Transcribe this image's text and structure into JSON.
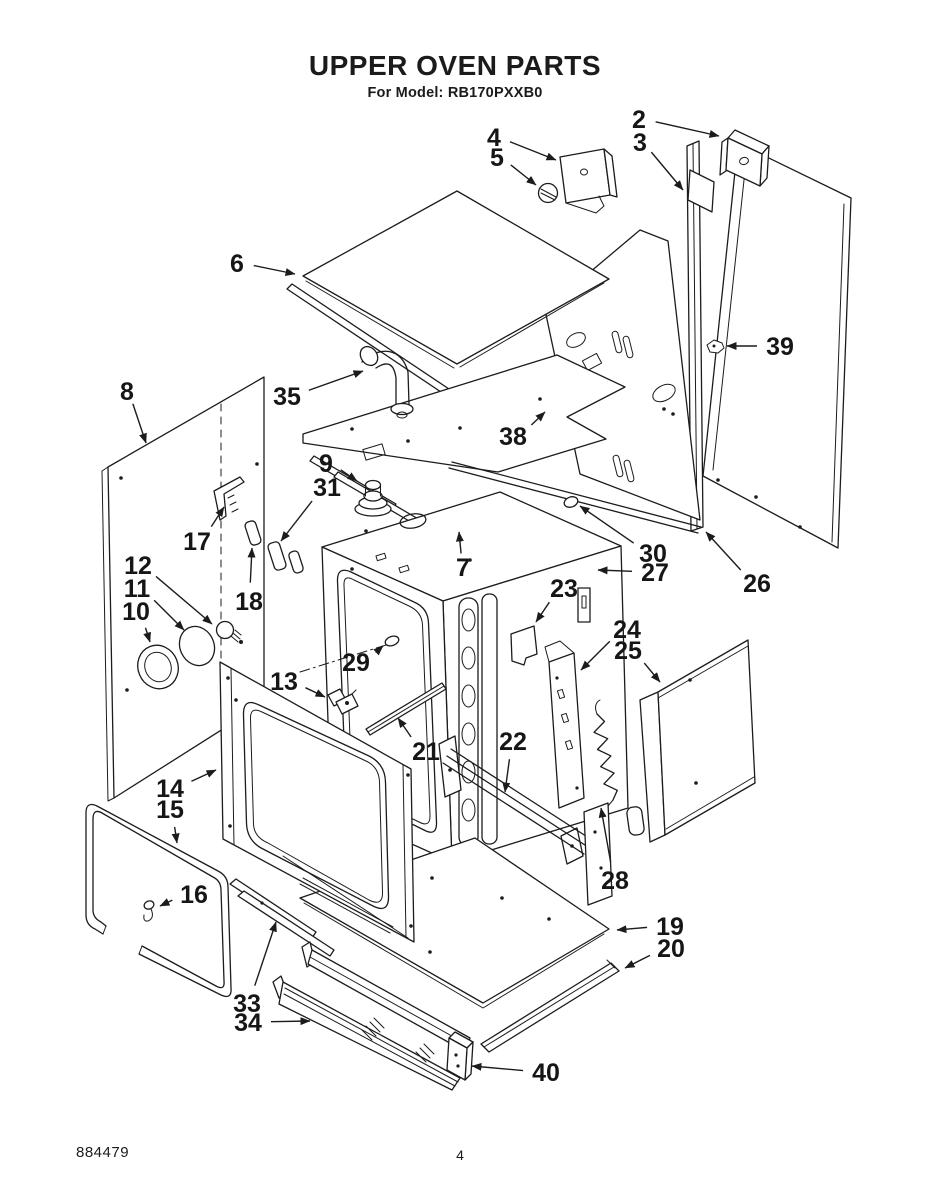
{
  "page": {
    "title": "UPPER OVEN PARTS",
    "subtitle": "For Model: RB170PXXB0",
    "doc_number": "884479",
    "page_number": "4"
  },
  "diagram": {
    "kind": "exploded-parts-diagram",
    "ink_color": "#1c1c1c",
    "paper_color": "#ffffff",
    "callouts": [
      {
        "label": "2",
        "lx": 639,
        "ly": 119,
        "tx": 719,
        "ty": 136
      },
      {
        "label": "3",
        "lx": 640,
        "ly": 142,
        "tx": 683,
        "ty": 190
      },
      {
        "label": "4",
        "lx": 494,
        "ly": 137,
        "tx": 556,
        "ty": 160
      },
      {
        "label": "5",
        "lx": 497,
        "ly": 157,
        "tx": 536,
        "ty": 185
      },
      {
        "label": "6",
        "lx": 237,
        "ly": 263,
        "tx": 295,
        "ty": 274
      },
      {
        "label": "8",
        "lx": 127,
        "ly": 391,
        "tx": 146,
        "ty": 443
      },
      {
        "label": "35",
        "lx": 287,
        "ly": 396,
        "tx": 363,
        "ty": 371
      },
      {
        "label": "38",
        "lx": 513,
        "ly": 436,
        "tx": 545,
        "ty": 412
      },
      {
        "label": "39",
        "lx": 780,
        "ly": 346,
        "tx": 727,
        "ty": 346
      },
      {
        "label": "9",
        "lx": 326,
        "ly": 463,
        "tx": 357,
        "ty": 481
      },
      {
        "label": "31",
        "lx": 327,
        "ly": 487,
        "tx": 281,
        "ty": 541
      },
      {
        "label": "17",
        "lx": 197,
        "ly": 541,
        "tx": 224,
        "ty": 507
      },
      {
        "label": "12",
        "lx": 138,
        "ly": 565,
        "tx": 212,
        "ty": 624
      },
      {
        "label": "11",
        "lx": 137,
        "ly": 588,
        "tx": 184,
        "ty": 630
      },
      {
        "label": "10",
        "lx": 136,
        "ly": 611,
        "tx": 150,
        "ty": 642
      },
      {
        "label": "18",
        "lx": 249,
        "ly": 601,
        "tx": 252,
        "ty": 548
      },
      {
        "label": "30",
        "lx": 653,
        "ly": 553,
        "tx": 580,
        "ty": 506
      },
      {
        "label": "27",
        "lx": 655,
        "ly": 572,
        "tx": 598,
        "ty": 570
      },
      {
        "label": "26",
        "lx": 757,
        "ly": 583,
        "tx": 706,
        "ty": 532
      },
      {
        "label": "7",
        "lx": 463,
        "ly": 567,
        "tx": 459,
        "ty": 532
      },
      {
        "label": "23",
        "lx": 564,
        "ly": 588,
        "tx": 536,
        "ty": 622
      },
      {
        "label": "29",
        "lx": 356,
        "ly": 662,
        "tx": 383,
        "ty": 646
      },
      {
        "label": "24",
        "lx": 627,
        "ly": 629,
        "tx": 581,
        "ty": 670
      },
      {
        "label": "25",
        "lx": 628,
        "ly": 650,
        "tx": 660,
        "ty": 682
      },
      {
        "label": "13",
        "lx": 284,
        "ly": 681,
        "tx": 325,
        "ty": 697
      },
      {
        "label": "21",
        "lx": 426,
        "ly": 751,
        "tx": 398,
        "ty": 718
      },
      {
        "label": "22",
        "lx": 513,
        "ly": 741,
        "tx": 505,
        "ty": 792
      },
      {
        "label": "14",
        "lx": 170,
        "ly": 788,
        "tx": 216,
        "ty": 770
      },
      {
        "label": "15",
        "lx": 170,
        "ly": 809,
        "tx": 177,
        "ty": 843
      },
      {
        "label": "16",
        "lx": 194,
        "ly": 894,
        "tx": 160,
        "ty": 906
      },
      {
        "label": "28",
        "lx": 615,
        "ly": 880,
        "tx": 601,
        "ty": 808
      },
      {
        "label": "19",
        "lx": 670,
        "ly": 926,
        "tx": 617,
        "ty": 930
      },
      {
        "label": "20",
        "lx": 671,
        "ly": 948,
        "tx": 625,
        "ty": 968
      },
      {
        "label": "33",
        "lx": 247,
        "ly": 1003,
        "tx": 276,
        "ty": 922
      },
      {
        "label": "34",
        "lx": 248,
        "ly": 1022,
        "tx": 310,
        "ty": 1021
      },
      {
        "label": "40",
        "lx": 546,
        "ly": 1072,
        "tx": 472,
        "ty": 1066
      }
    ]
  }
}
